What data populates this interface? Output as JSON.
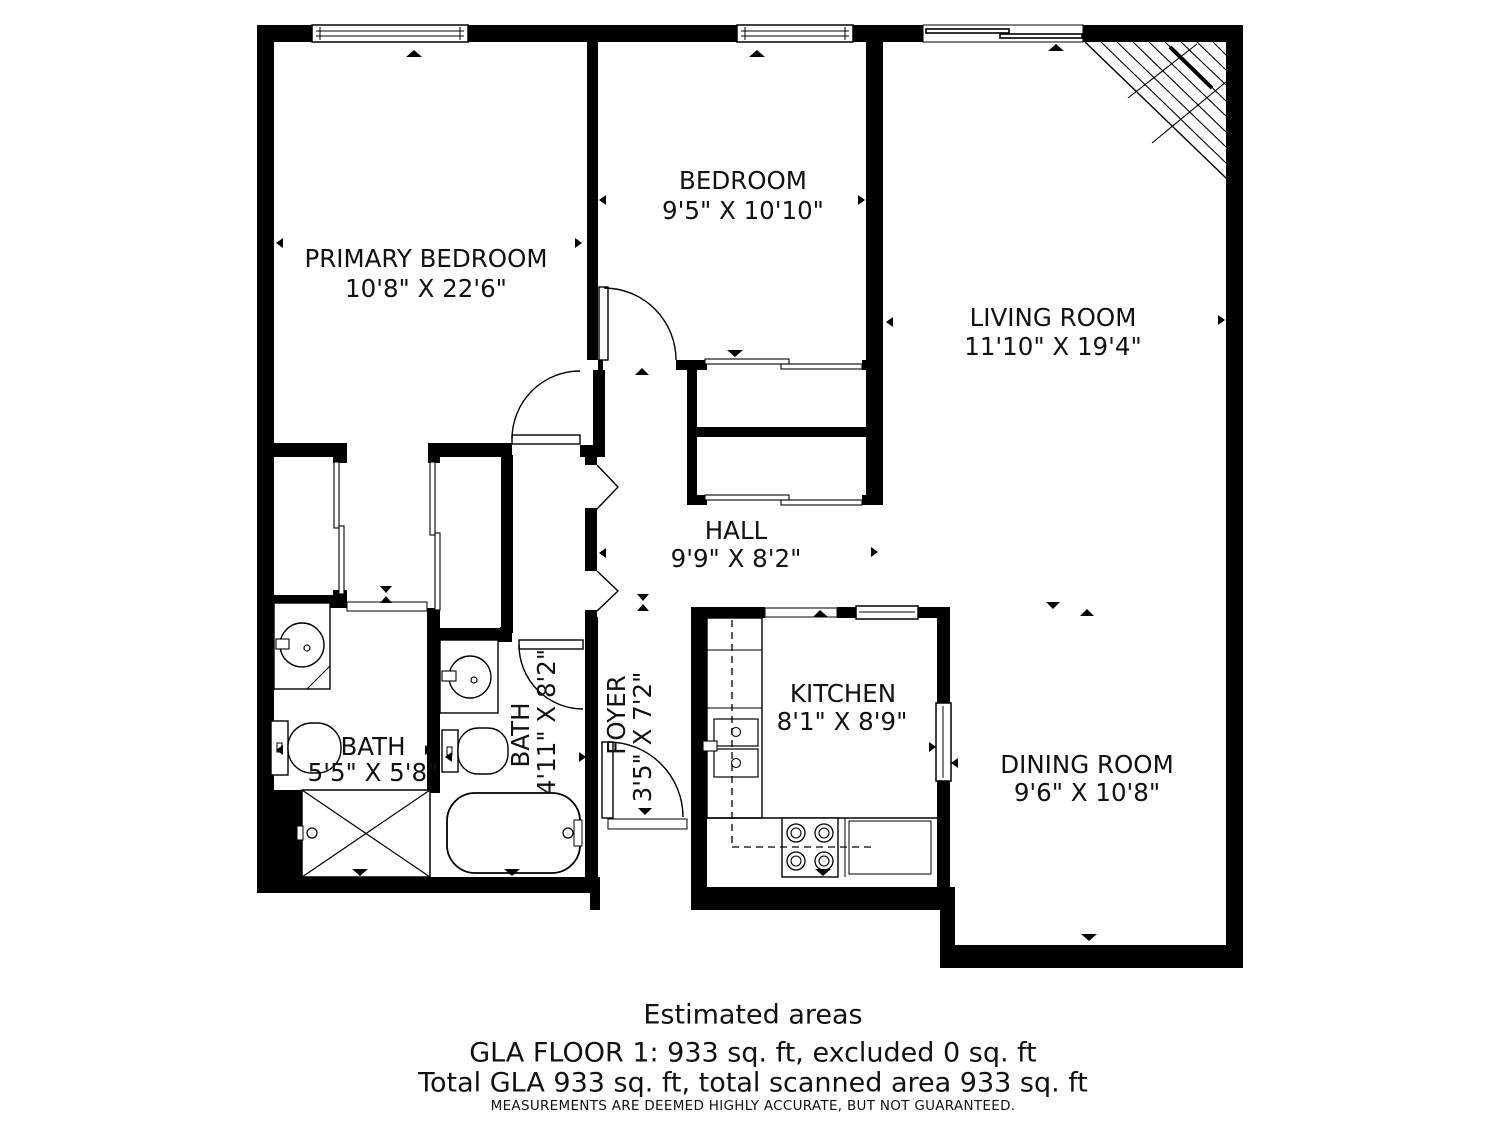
{
  "rooms": [
    {
      "name": "PRIMARY BEDROOM",
      "dims": "10'8\" X 22'6\""
    },
    {
      "name": "BEDROOM",
      "dims": "9'5\" X 10'10\""
    },
    {
      "name": "LIVING ROOM",
      "dims": "11'10\" X 19'4\""
    },
    {
      "name": "HALL",
      "dims": "9'9\" X 8'2\""
    },
    {
      "name": "BATH",
      "dims": "5'5\" X 5'8\""
    },
    {
      "name": "BATH",
      "dims": "4'11\" X 8'2\""
    },
    {
      "name": "FOYER",
      "dims": "3'5\" X 7'2\""
    },
    {
      "name": "KITCHEN",
      "dims": "8'1\" X 8'9\""
    },
    {
      "name": "DINING ROOM",
      "dims": "9'6\" X 10'8\""
    }
  ],
  "footer": {
    "title": "Estimated areas",
    "line1": "GLA FLOOR 1: 933 sq. ft, excluded 0 sq. ft",
    "line2": "Total GLA 933 sq. ft, total scanned area 933 sq. ft",
    "disclaimer": "MEASUREMENTS ARE DEEMED HIGHLY ACCURATE, BUT NOT GUARANTEED."
  },
  "colors": {
    "wall": "#000000",
    "background": "#ffffff",
    "text": "#111111"
  }
}
